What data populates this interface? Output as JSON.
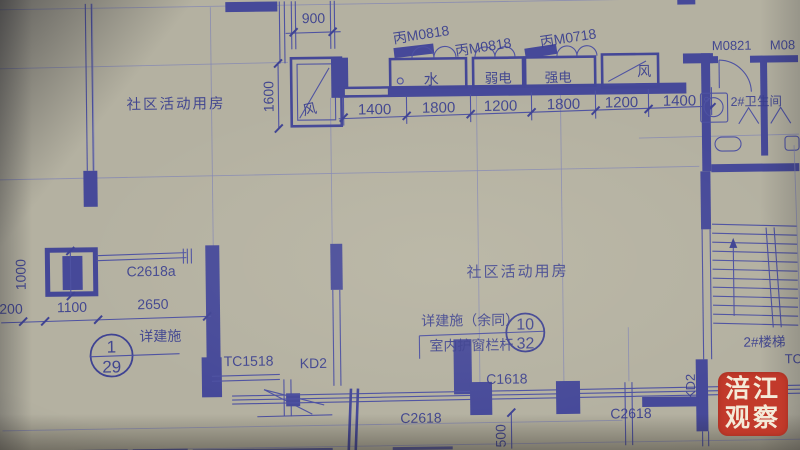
{
  "labels": {
    "room_top_left": "社区活动用房",
    "room_center": "社区活动用房",
    "shaft_air_left": "风",
    "shaft_water": "水",
    "shaft_weak_current": "弱电",
    "shaft_strong_current": "强电",
    "shaft_air_right": "风",
    "door_fm0818_a": "丙M0818",
    "door_fm0818_b": "丙M0818",
    "door_fm0718": "丙M0718",
    "door_m0821": "M0821",
    "door_m08_partial": "M08",
    "bathroom_2": "2#卫生间",
    "stair_2": "2#楼梯",
    "tc_partial": "TC1",
    "window_c2618a": "C2618a",
    "window_tc1518": "TC1518",
    "door_kd2_bottom": "KD2",
    "door_kd2_right": "KD2",
    "window_c1618": "C1618",
    "window_c2618_left": "C2618",
    "window_c2618_right": "C2618",
    "note_detail": "详建施",
    "note_detail_rest": "详建施（余同）",
    "note_rail": "室内护窗栏杆"
  },
  "bubbles": {
    "b1_top": "1",
    "b1_bottom": "29",
    "b2_top": "10",
    "b2_bottom": "32"
  },
  "dimensions": {
    "d900": "900",
    "top_row": [
      "1400",
      "1800",
      "1200",
      "1800",
      "1200",
      "1400"
    ],
    "d1600": "1600",
    "d1000": "1000",
    "left_row": [
      "200",
      "1100",
      "2650"
    ],
    "d500": "500"
  },
  "watermark": {
    "line1": "涪江",
    "line2": "观察"
  },
  "colors": {
    "paper": "#b4b1a1",
    "ink": "#3a3f96",
    "wall": "#45499f",
    "faint_line": "#8084b8",
    "stamp_bg": "#c23a2b",
    "stamp_text": "#f4ead8"
  }
}
